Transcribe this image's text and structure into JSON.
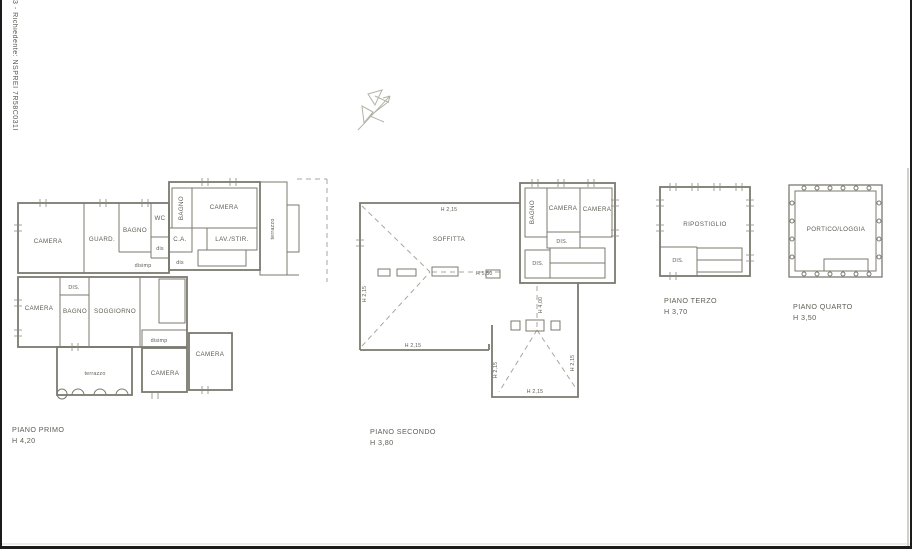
{
  "sheet": {
    "margin_note": "3 - Richiedente: NSPREI 7R58C031I"
  },
  "colors": {
    "wall": "#7b7a6f",
    "text": "#5e5d53",
    "dashed_line": "#a8a79c",
    "north_arrow": "#b3b2a8",
    "page_border": "#1b1b1b"
  },
  "floors": [
    {
      "caption": "PIANO PRIMO",
      "height": "H 4,20",
      "rooms": {
        "camera_nw": "CAMERA",
        "guardaroba": "GUARD.",
        "bagno_n": "BAGNO",
        "wc": "WC",
        "dis_n": "dis",
        "ca": "C.A.",
        "dis_e": "dis",
        "disimp_n": "disimp",
        "bagno_e": "BAGNO",
        "camera_ne": "CAMERA",
        "lav_stir": "LAV./STIR.",
        "terrazzo_e": "terrazzo",
        "dis_c": "DIS.",
        "camera_w": "CAMERA",
        "bagno_w": "BAGNO",
        "soggiorno": "SOGGIORNO",
        "disimp_s": "disimp",
        "terrazzo_s": "terrazzo",
        "camera_s1": "CAMERA",
        "camera_s2": "CAMERA"
      }
    },
    {
      "caption": "PIANO SECONDO",
      "height": "H 3,80",
      "rooms": {
        "soffitta": "SOFFITTA",
        "bagno": "BAGNO",
        "camera_1": "CAMERA",
        "camera_2": "CAMERA",
        "dis_1": "DIS.",
        "dis_2": "DIS."
      },
      "measures": {
        "h_top": "H 2,15",
        "h_ridge": "H 5,50",
        "h_left": "H 2,15",
        "h_bottom": "H 2,15",
        "h_center": "H 4,00",
        "h_right": "H 2,15",
        "h_ext_left": "H 2,15",
        "h_ext_bottom": "H 2,15"
      }
    },
    {
      "caption": "PIANO TERZO",
      "height": "H 3,70",
      "rooms": {
        "ripostiglio": "RIPOSTIGLIO",
        "dis": "DIS."
      }
    },
    {
      "caption": "PIANO QUARTO",
      "height": "H 3,50",
      "rooms": {
        "portico": "PORTICO/LOGGIA"
      }
    }
  ]
}
